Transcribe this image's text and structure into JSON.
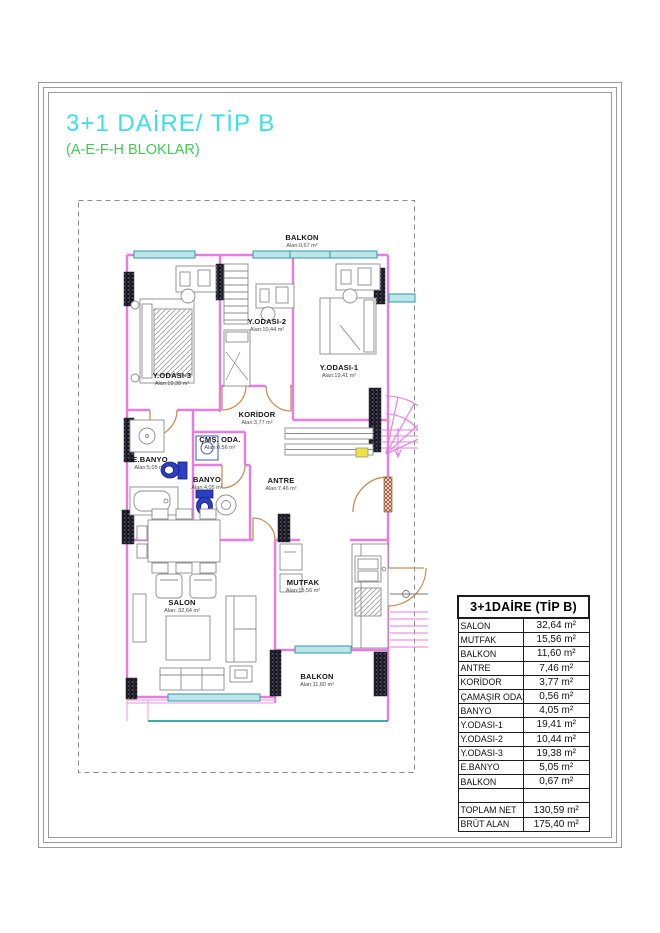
{
  "title": "3+1 DAİRE/ TİP B",
  "subtitle": "(A-E-F-H BLOKLAR)",
  "plan": {
    "rooms": [
      {
        "name": "BALKON",
        "area": "Alan:0,67 m²"
      },
      {
        "name": "Y.ODASI-3",
        "area": "Alan:19,38 m²"
      },
      {
        "name": "Y.ODASI-2",
        "area": "Alan:10,44 m²"
      },
      {
        "name": "Y.ODASI-1",
        "area": "Alan:19,41 m²"
      },
      {
        "name": "KORİDOR",
        "area": "Alan:3,77 m²"
      },
      {
        "name": "ÇMŞ. ODA.",
        "area": "Alan:0,56 m²"
      },
      {
        "name": "E.BANYO",
        "area": "Alan:5,05 m²"
      },
      {
        "name": "BANYO",
        "area": "Alan:4,05 m²"
      },
      {
        "name": "ANTRE",
        "area": "Alan:7,46 m²"
      },
      {
        "name": "SALON",
        "area": "Alan: 32,64 m²"
      },
      {
        "name": "MUTFAK",
        "area": "Alan:15,56 m²"
      },
      {
        "name": "BALKON",
        "area": "Alan:11,60 m²"
      }
    ]
  },
  "table": {
    "header": "3+1DAİRE (TİP B)",
    "rows": [
      {
        "label": "SALON",
        "value": "32,64 m²"
      },
      {
        "label": "MUTFAK",
        "value": "15,56 m²"
      },
      {
        "label": "BALKON",
        "value": "11,60 m²"
      },
      {
        "label": "ANTRE",
        "value": "7,46 m²"
      },
      {
        "label": "KORİDOR",
        "value": "3,77 m²"
      },
      {
        "label": "ÇAMAŞIR ODASI",
        "value": "0,56 m²"
      },
      {
        "label": "BANYO",
        "value": "4,05 m²"
      },
      {
        "label": "Y.ODASI-1",
        "value": "19,41 m²"
      },
      {
        "label": "Y.ODASI-2",
        "value": "10,44 m²"
      },
      {
        "label": "Y.ODASI-3",
        "value": "19,38 m²"
      },
      {
        "label": "E.BANYO",
        "value": "5,05 m²"
      },
      {
        "label": "BALKON",
        "value": "0,67 m²"
      },
      {
        "label": "",
        "value": ""
      },
      {
        "label": "TOPLAM NET",
        "value": "130,59 m²"
      },
      {
        "label": "BRÜT ALAN",
        "value": "175,40 m²"
      }
    ]
  },
  "colors": {
    "title_cyan": "#3EDEE2",
    "subtitle_green": "#3ECC52",
    "wall_magenta": "#E87CE0",
    "window_cyan_fill": "#BCE6EA",
    "window_cyan_frame": "#2E9AA6",
    "door_tan": "#C89058",
    "toilet_blue": "#2B3FBF",
    "highlight_yellow": "#EEE33E",
    "boundary_gray": "#8A8A8A"
  }
}
